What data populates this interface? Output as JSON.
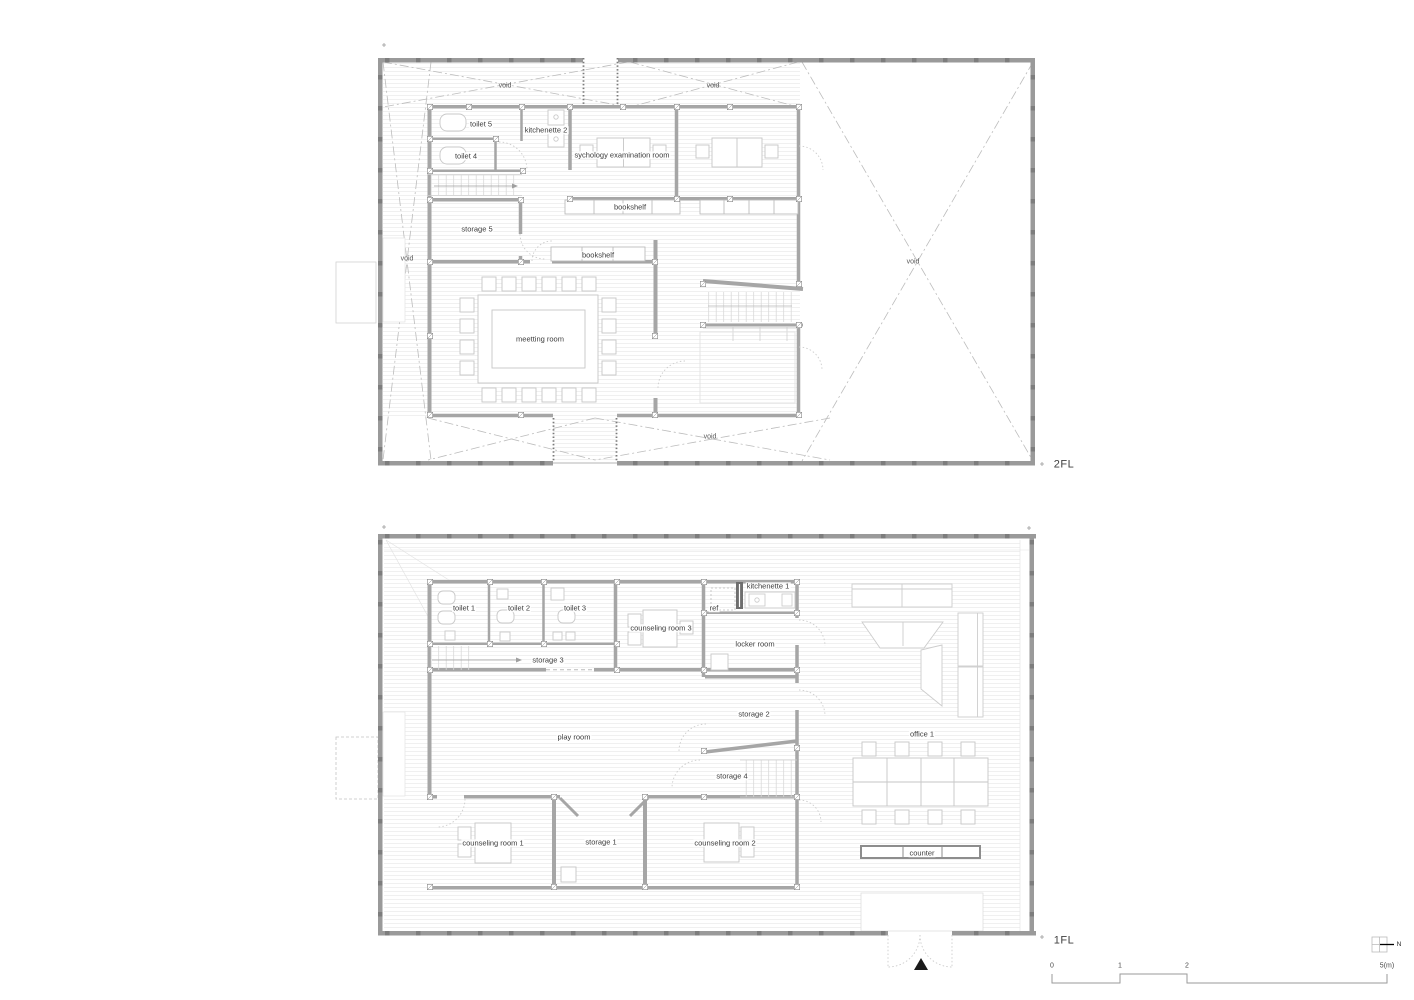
{
  "floor2": {
    "label": "2FL",
    "rooms": {
      "void_top_left": "void",
      "void_top_right": "void",
      "toilet5": "toilet 5",
      "kitchenette2": "kitchenette 2",
      "toilet4": "toilet 4",
      "psych_exam": "sychology examination room",
      "bookshelf_top": "bookshelf",
      "storage5": "storage 5",
      "void_left": "void",
      "bookshelf_mid": "bookshelf",
      "void_right": "void",
      "meeting": "meetting room",
      "void_bottom": "void"
    }
  },
  "floor1": {
    "label": "1FL",
    "rooms": {
      "toilet1": "toilet 1",
      "toilet2": "toilet 2",
      "toilet3": "toilet 3",
      "counseling3": "counseling room 3",
      "kitchenette1": "kitchenette 1",
      "ref": "ref",
      "locker": "locker room",
      "storage3": "storage 3",
      "storage2": "storage 2",
      "playroom": "play room",
      "office1": "office 1",
      "storage4": "storage 4",
      "counseling1": "counseling room 1",
      "storage1": "storage 1",
      "counseling2": "counseling room 2",
      "counter": "counter"
    }
  },
  "scale_bar": {
    "tick0": "0",
    "tick1": "1",
    "tick2": "2",
    "tick5": "5(m)"
  },
  "north": {
    "label": "N"
  }
}
